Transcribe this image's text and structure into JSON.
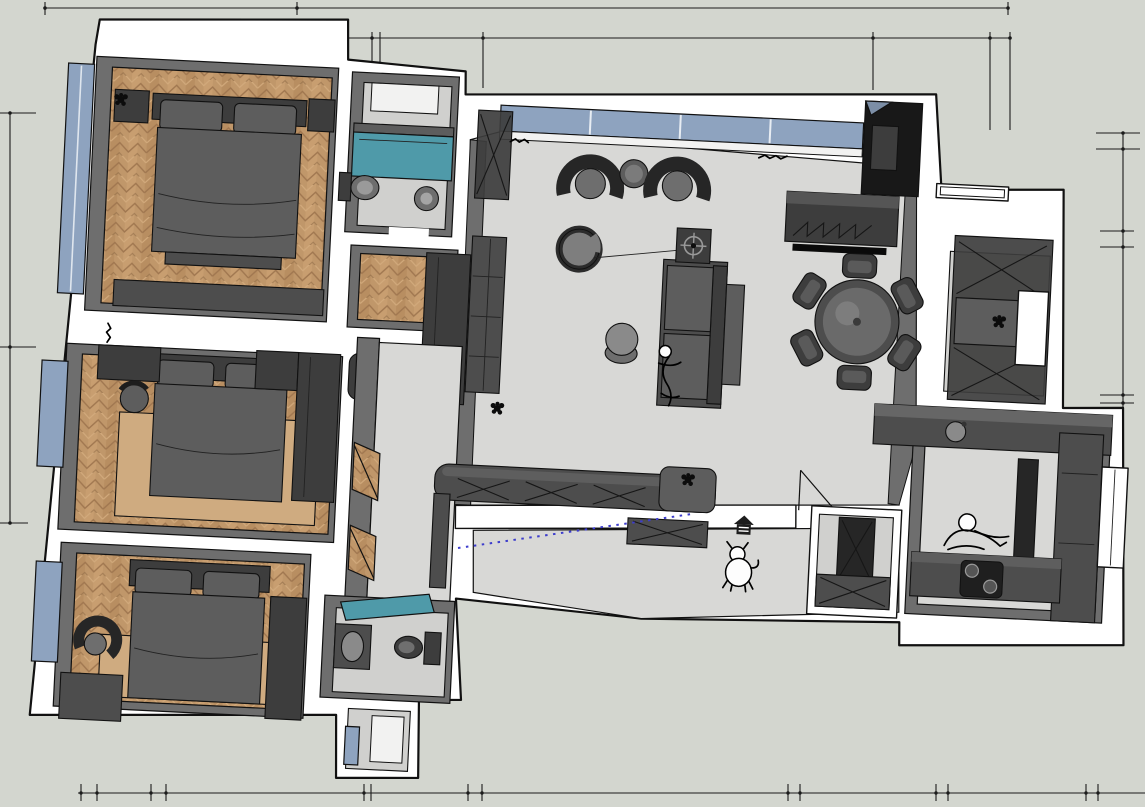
{
  "scene": {
    "kind": "sketchup-style-3d-floorplan-top-view",
    "width": 1145,
    "height": 807,
    "visible_text": "",
    "view": "bird's-eye apartment plan, slightly rotated perspective"
  },
  "palette": {
    "background": "#d3d6cf",
    "wall": "#ffffff",
    "wall_face": "#6e6e6e",
    "outline": "#111111",
    "wood_floor": "#c0976a",
    "wood_stripe_dark": "#a07750",
    "wood_stripe_light": "#d2aa7c",
    "tile_floor": "#d8d8d6",
    "bath_floor": "#d0d0ce",
    "rug": "#cfab80",
    "window_glass": "#8ea3bf",
    "water_teal": "#4f9aa9",
    "furniture_darkest": "#262626",
    "furniture_dark": "#3d3d3d",
    "furniture_mid": "#4d4d4d",
    "furniture_light": "#6e6e6e",
    "guide_blue": "#3d3dcc"
  },
  "rooms": [
    {
      "id": "bedroom-master",
      "floor": "wood-herringbone",
      "furniture": [
        "double-bed",
        "pillows",
        "nightstand-left",
        "nightstand-right",
        "dresser",
        "window-left",
        "plant"
      ]
    },
    {
      "id": "bathroom-top",
      "floor": "tile",
      "furniture": [
        "bathtub-teal",
        "toilet",
        "pedestal-basin",
        "skylight"
      ]
    },
    {
      "id": "dressing-area",
      "floor": "wood-herringbone",
      "furniture": [
        "l-shaped-cabinet"
      ]
    },
    {
      "id": "bedroom-middle",
      "floor": "wood-herringbone",
      "furniture": [
        "double-bed",
        "pillows",
        "rug",
        "desk",
        "desk-chair",
        "wardrobe",
        "corner-cabinet",
        "window-left"
      ]
    },
    {
      "id": "bedroom-bottom",
      "floor": "wood-herringbone",
      "furniture": [
        "double-bed",
        "pillows",
        "rug",
        "armchair",
        "low-cabinet",
        "wardrobe",
        "window-left"
      ]
    },
    {
      "id": "bathroom-bottom",
      "floor": "tile",
      "furniture": [
        "washbasin",
        "toilet",
        "teal-shower-glass",
        "shower-stall-window"
      ]
    },
    {
      "id": "corridor",
      "floor": "tile",
      "furniture": [
        "door-wedges"
      ]
    },
    {
      "id": "living-room",
      "floor": "tile",
      "furniture": [
        "window-band",
        "armchair-pair",
        "round-side-table",
        "swivel-chair",
        "arc-floor-lamp",
        "ottoman-stool",
        "sofa",
        "person-sketch",
        "side-table-target",
        "tall-cabinet-x",
        "bookcase",
        "tv-console",
        "black-media-niche",
        "wall-scribbles"
      ]
    },
    {
      "id": "dining-area",
      "floor": "tile",
      "furniture": [
        "round-table",
        "six-chairs"
      ]
    },
    {
      "id": "bay-cabinet-nook",
      "floor": "tile",
      "furniture": [
        "x-front-cabinet-top",
        "open-shelf-plant",
        "x-front-cabinet-bottom",
        "window-opening",
        "ledge"
      ]
    },
    {
      "id": "hallway-sideboard",
      "floor": "tile",
      "furniture": [
        "rounded-x-front-sideboard",
        "plant"
      ]
    },
    {
      "id": "entry",
      "floor": "tile",
      "furniture": [
        "door-swing",
        "dog-sketch",
        "pet-house-icon",
        "low-x-cabinet",
        "utility-closet-x-cabinets"
      ]
    },
    {
      "id": "kitchen",
      "floor": "tile",
      "furniture": [
        "north-counter-sink",
        "south-counter-cooktop",
        "tall-unit-column",
        "east-tall-units",
        "window-right",
        "person-sketch"
      ]
    }
  ],
  "annotations": {
    "dimension_lines": {
      "top": {
        "lines": 2,
        "style": "black tick-and-dot dimension strings, no numerals"
      },
      "bottom": {
        "lines": 1,
        "tick_pairs": 7
      },
      "left": {
        "lines": 1,
        "ticks": 3
      },
      "right": {
        "lines": 1,
        "tick_pairs": 3
      }
    },
    "guide_line": {
      "style": "blue dotted construction guide across entry floor"
    }
  }
}
